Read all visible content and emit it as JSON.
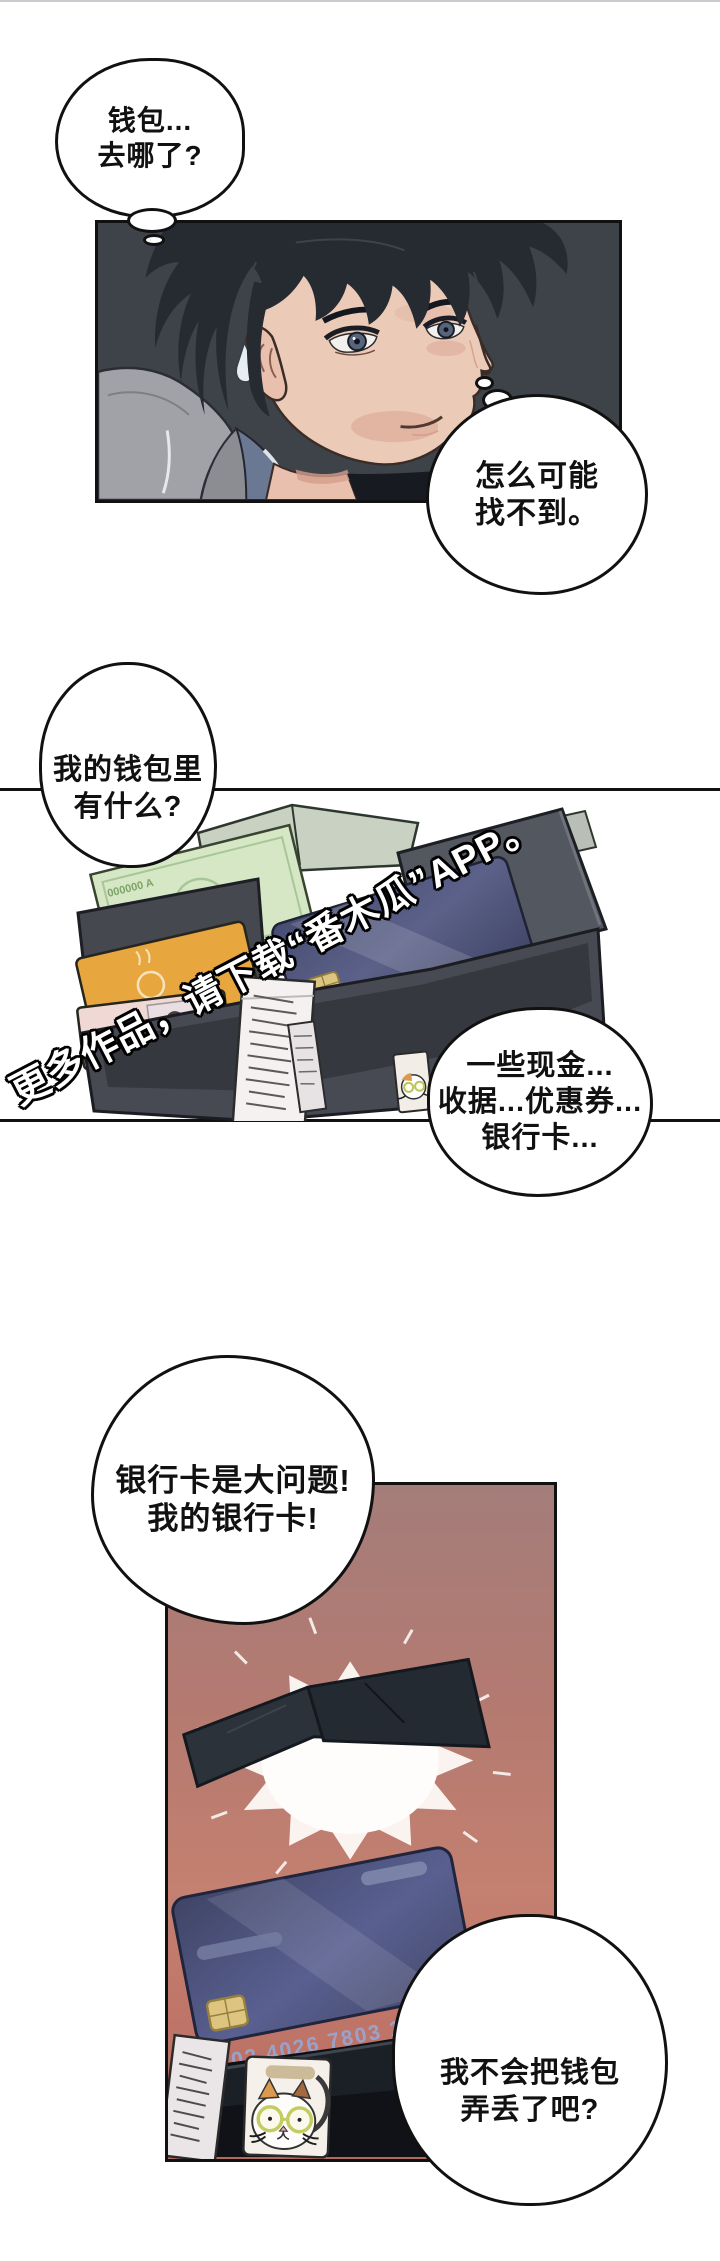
{
  "page": {
    "width": 720,
    "height": 2261,
    "background": "#ffffff",
    "top_rule_color": "#c9ccd0"
  },
  "colors": {
    "outline": "#111111",
    "panel1_bg": "#3e434a",
    "panel3_top": "#a47d7a",
    "panel3_mid": "#c48070",
    "panel3_bottom": "#b06a60",
    "card_navy": "#474d72",
    "chip_gold": "#dcc581",
    "banknote_green": "#d6e7c6",
    "orange_card": "#e8a63f",
    "pink_card": "#f0d9d5",
    "wallet_leather": "#53575f",
    "wallet_dark": "#1b1f26",
    "starburst": "#fffdfb"
  },
  "bubbles": {
    "bubble_1": {
      "type": "thought",
      "lines": [
        "钱包...",
        "去哪了?"
      ]
    },
    "bubble_2": {
      "type": "thought",
      "lines": [
        "怎么可能",
        "找不到。"
      ]
    },
    "bubble_3": {
      "type": "round",
      "lines": [
        "我的钱包里",
        "有什么?"
      ]
    },
    "bubble_4": {
      "type": "round",
      "lines": [
        "一些现金...",
        "收据...优惠券...",
        "银行卡..."
      ]
    },
    "bubble_5": {
      "type": "round",
      "lines": [
        "银行卡是大问题!",
        "我的银行卡!"
      ]
    },
    "bubble_6": {
      "type": "round",
      "lines": [
        "我不会把钱包",
        "弄丢了吧?"
      ]
    }
  },
  "watermark": {
    "text": "更多作品，请下载“番木瓜”APP。",
    "fill": "#ffffff",
    "outline": "#000000"
  },
  "artwork": {
    "banknote_serial": "000000 A",
    "card1_number": "4326 7803 1011",
    "card2_number": "0102 4026 7803 1011"
  }
}
